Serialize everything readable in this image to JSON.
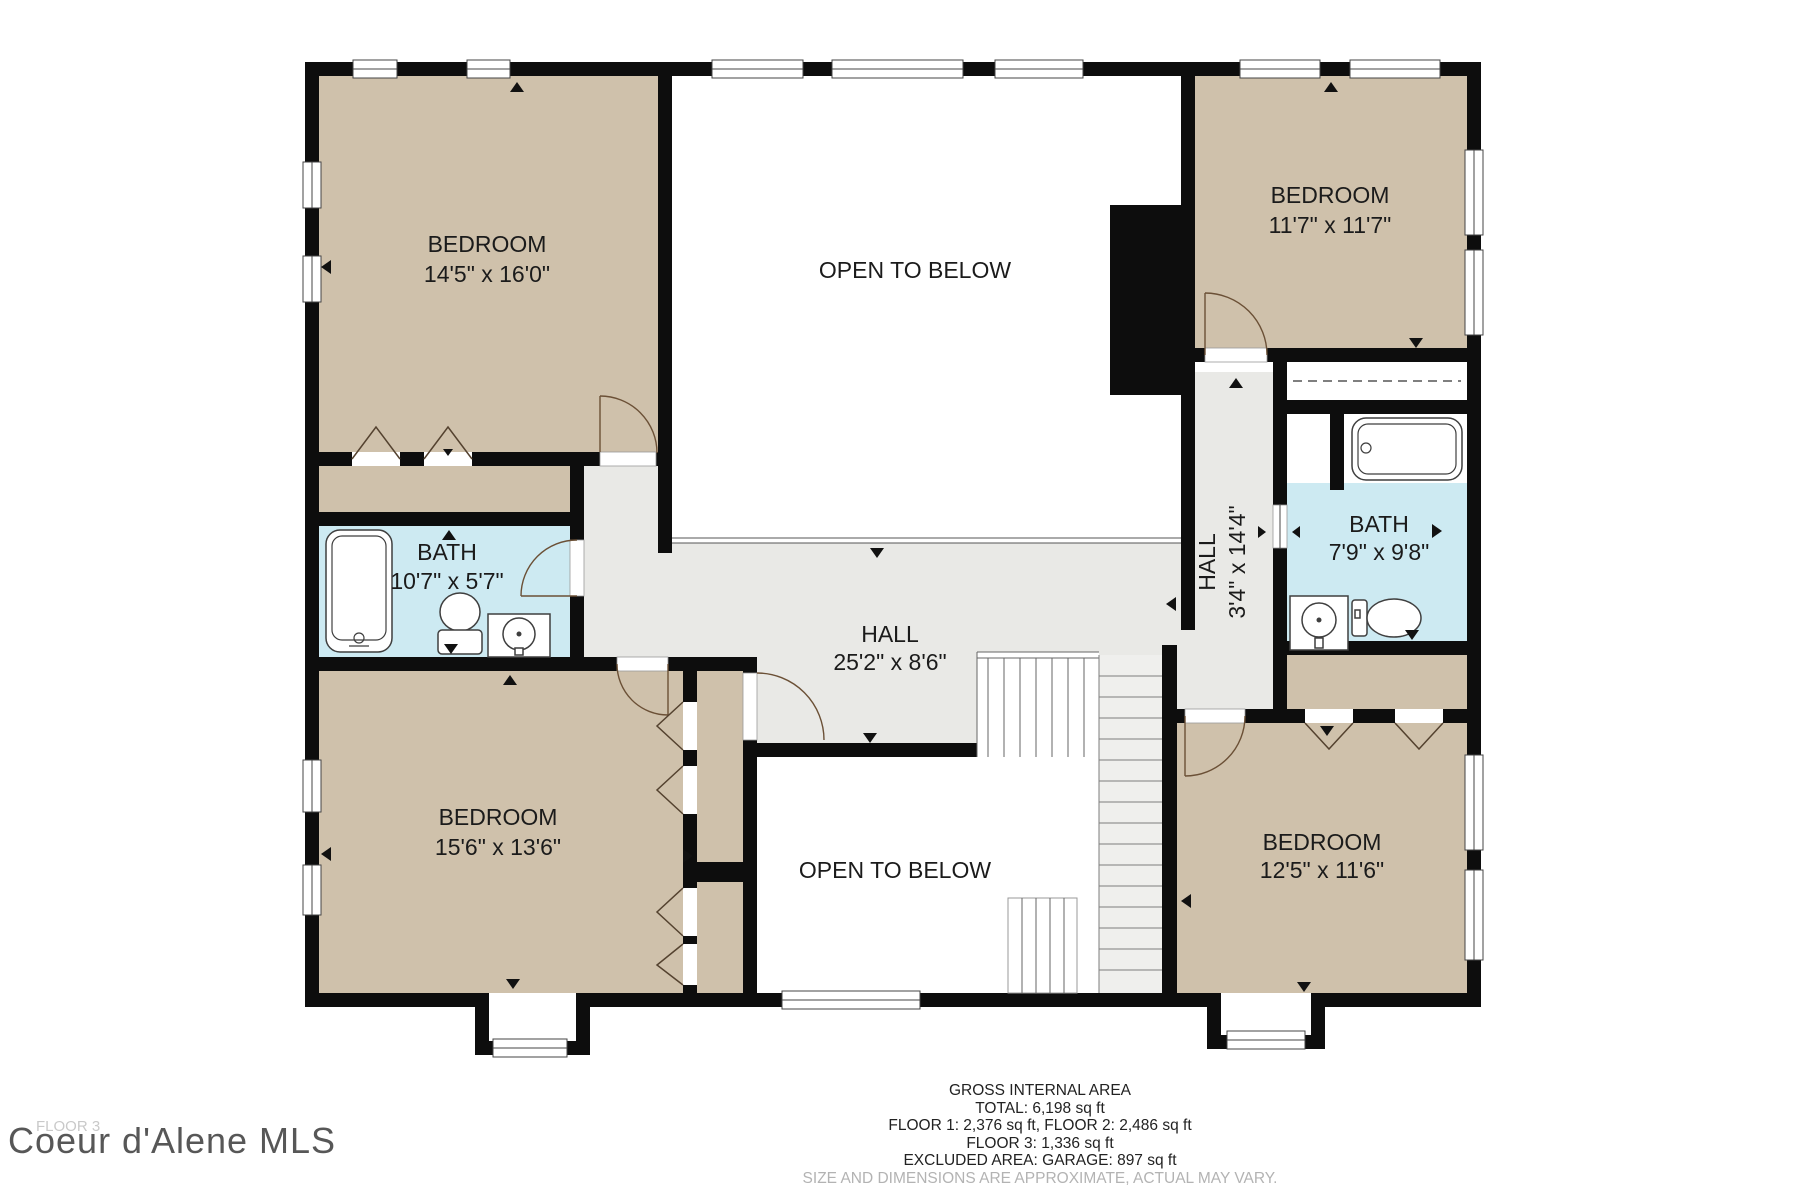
{
  "plan": {
    "floor_label": "FLOOR 3",
    "watermark": "Coeur d'Alene MLS",
    "rooms": [
      {
        "id": "bedroom-top-left",
        "name": "BEDROOM",
        "dims": "14'5\" x 16'0\""
      },
      {
        "id": "open-to-below-top",
        "name": "OPEN TO BELOW",
        "dims": ""
      },
      {
        "id": "bedroom-top-right",
        "name": "BEDROOM",
        "dims": "11'7\" x 11'7\""
      },
      {
        "id": "bath-left",
        "name": "BATH",
        "dims": "10'7\" x 5'7\""
      },
      {
        "id": "hall-main",
        "name": "HALL",
        "dims": "25'2\" x 8'6\""
      },
      {
        "id": "hall-vertical",
        "name": "HALL",
        "dims": "3'4\" x 14'4\""
      },
      {
        "id": "bath-right",
        "name": "BATH",
        "dims": "7'9\" x 9'8\""
      },
      {
        "id": "bedroom-bottom-left",
        "name": "BEDROOM",
        "dims": "15'6\" x 13'6\""
      },
      {
        "id": "open-to-below-bottom",
        "name": "OPEN TO BELOW",
        "dims": ""
      },
      {
        "id": "bedroom-bottom-right",
        "name": "BEDROOM",
        "dims": "12'5\" x 11'6\""
      }
    ],
    "area_summary": {
      "title": "GROSS INTERNAL AREA",
      "total": "TOTAL: 6,198 sq ft",
      "floors_1_2": "FLOOR 1: 2,376 sq ft, FLOOR 2: 2,486 sq ft",
      "floor_3": "FLOOR 3: 1,336 sq ft",
      "excluded": "EXCLUDED AREA: GARAGE: 897 sq ft",
      "disclaimer": "SIZE AND DIMENSIONS ARE APPROXIMATE, ACTUAL MAY VARY."
    },
    "colors": {
      "wall": "#0d0d0d",
      "bedroom_fill": "#cfc1ab",
      "bath_fill": "#cdeaf2",
      "hall_fill": "#e9e9e6",
      "stairs_fill": "#efefed",
      "watermark_text": "#454545",
      "disclaimer_text": "#b3b3b3"
    }
  }
}
